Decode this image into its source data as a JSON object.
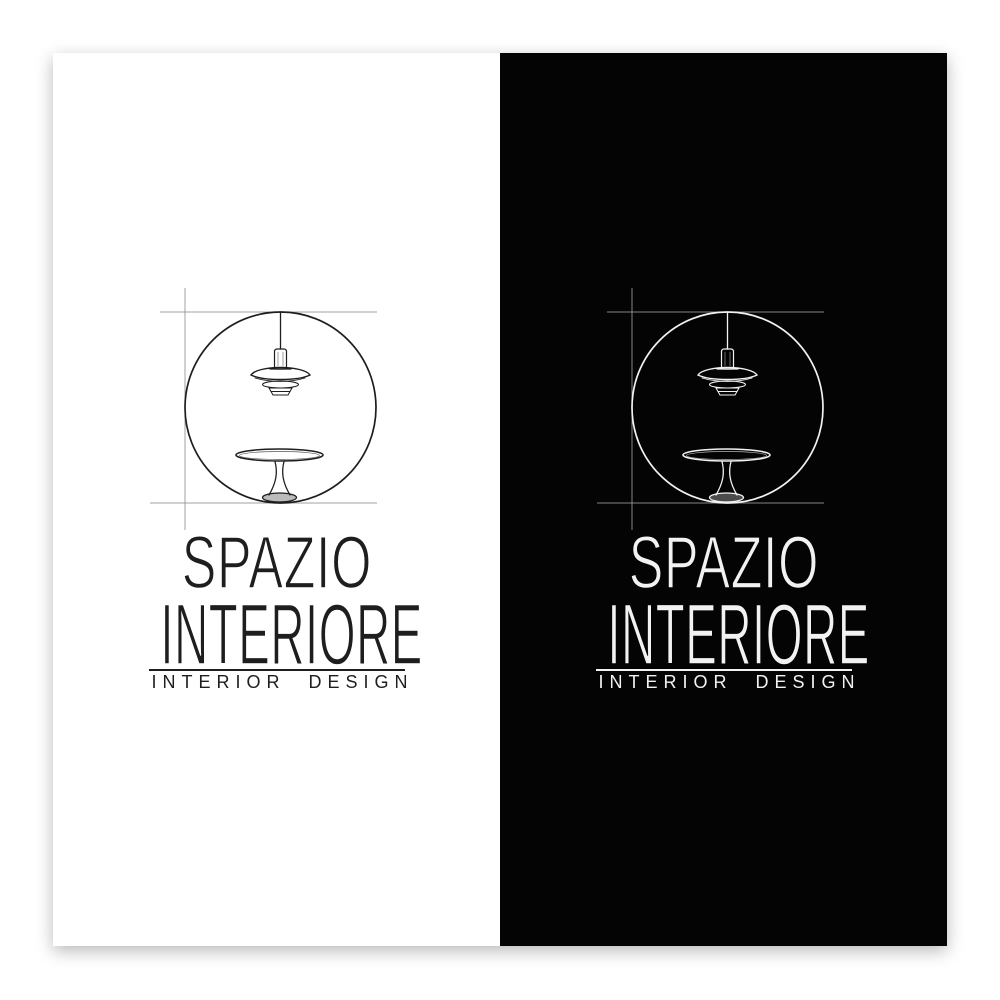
{
  "page": {
    "background_color": "#ffffff",
    "description_label": "logo-presentation-two-panels"
  },
  "brand": {
    "name_line1": "SPAZIO",
    "name_line2": "INTERIORE",
    "tagline": "INTERIOR DESIGN"
  },
  "logo_mark": {
    "icon": "pendant-lamp-and-pedestal-table-in-circle-sketch-icon",
    "elements": [
      "construction-cross-lines",
      "circle",
      "pendant-lamp",
      "round-pedestal-table"
    ]
  },
  "panels": [
    {
      "variant": "light",
      "background": "#ffffff",
      "ink": "#1e1e1e",
      "construction_line": "#8f8f8f"
    },
    {
      "variant": "dark",
      "background": "#040404",
      "ink": "#f2f2f2",
      "construction_line": "#9b9b9b"
    }
  ]
}
